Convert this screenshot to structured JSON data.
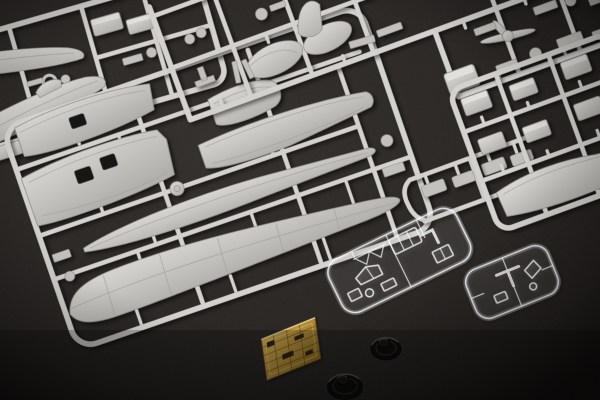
{
  "scene": {
    "description": "Overhead studio photograph of an unassembled plastic model aircraft kit: light gray injection-molded sprues holding fuselage halves, wing panels, a propeller and many small detail parts, two clear sprues with canopy sections, a brass photo-etched detail fret, and two black rubber tires with poly caps, all arranged on a dark charcoal fabric surface",
    "objects": [
      {
        "name": "fuselage-sprue",
        "label": "gray sprue with fuselage halves and small parts (top left)"
      },
      {
        "name": "wing-sprue",
        "label": "large gray sprue with wing panels, tailplane and lower wing (center left)"
      },
      {
        "name": "detail-grid-sprue",
        "label": "large gray grid sprue with cowlings, propeller and detail parts (top)"
      },
      {
        "name": "right-parts-sprue",
        "label": "gray sprue with small blocky parts (right edge)"
      },
      {
        "name": "right-strip-sprue",
        "label": "narrow gray sprue with slim parts (middle right)"
      },
      {
        "name": "clear-sprue-large",
        "label": "clear sprue with canopy and windscreen parts"
      },
      {
        "name": "clear-sprue-small",
        "label": "small clear sprue with transparencies"
      },
      {
        "name": "photo-etched-fret",
        "label": "brass photo-etched detail fret"
      },
      {
        "name": "rubber-tire-upper",
        "label": "black rubber tire with center poly cap"
      },
      {
        "name": "rubber-tire-lower",
        "label": "black rubber tire with center poly cap"
      }
    ]
  },
  "palette": {
    "background_dark": "#1a1715",
    "background_mid": "#262321",
    "background_light": "#312d2a",
    "sprue_light": "#d4d2ce",
    "sprue_mid": "#c3c1bd",
    "sprue_edge": "#8f8d89",
    "hole_dark": "#191715",
    "clear_plastic": "#f5f5f7",
    "pe_brass_light": "#caa24a",
    "pe_brass_dark": "#8e6e28",
    "tire_black": "#0d0c0b"
  }
}
